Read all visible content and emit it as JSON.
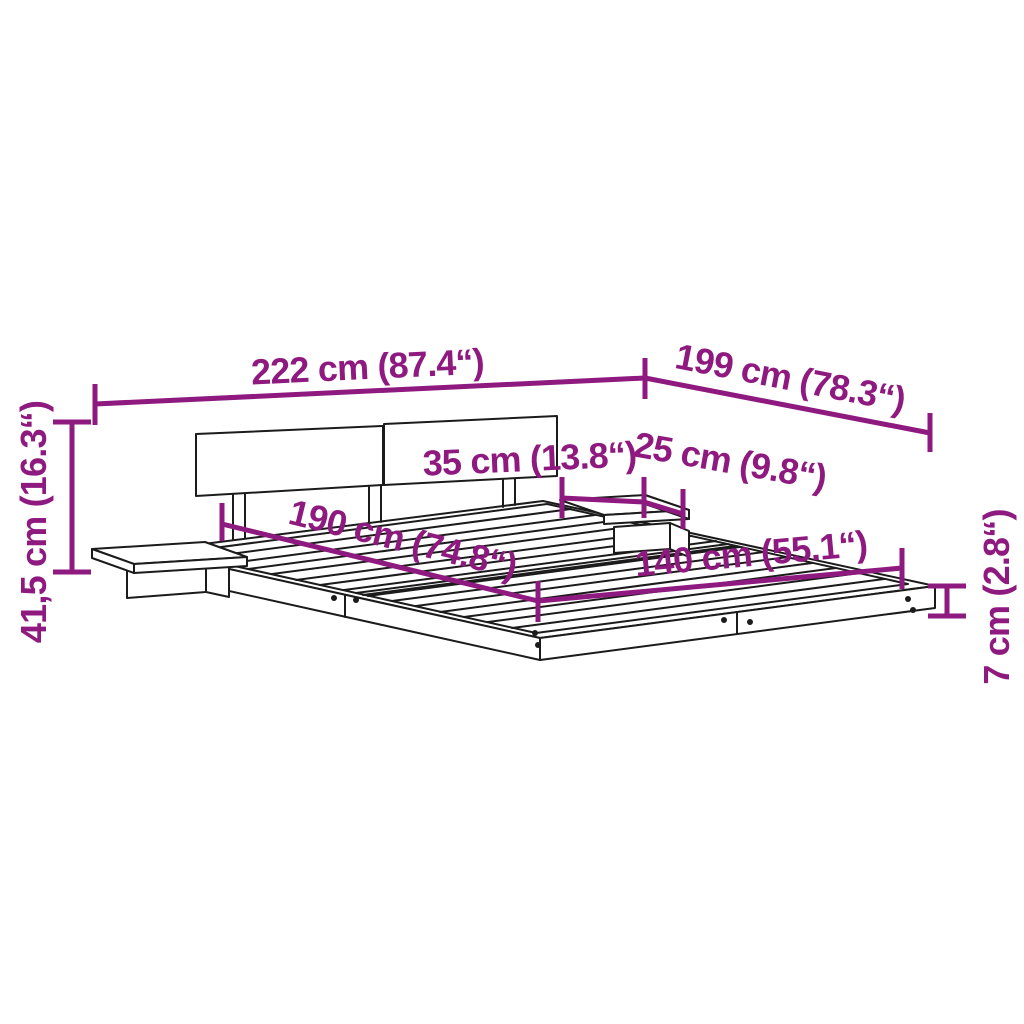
{
  "diagram": {
    "name": "bed-frame-dimension-diagram",
    "background": "#ffffff",
    "accent_color": "#8E1A80",
    "line_color": "#1b1b1b",
    "dimensions": [
      {
        "id": "total-width",
        "label": "222 cm (87.4“)",
        "value_cm": "222 cm",
        "value_inch": "87.4“"
      },
      {
        "id": "total-depth",
        "label": "199 cm (78.3“)",
        "value_cm": "199 cm",
        "value_inch": "78.3“"
      },
      {
        "id": "total-height",
        "label": "41,5 cm (16.3“)",
        "value_cm": "41,5 cm",
        "value_inch": "16.3“"
      },
      {
        "id": "shelf-depth",
        "label": "35 cm (13.8“)",
        "value_cm": "35 cm",
        "value_inch": "13.8“"
      },
      {
        "id": "shelf-width",
        "label": "25 cm (9.8“)",
        "value_cm": "25 cm",
        "value_inch": "9.8“"
      },
      {
        "id": "sleeping-length",
        "label": "190 cm (74.8“)",
        "value_cm": "190 cm",
        "value_inch": "74.8“"
      },
      {
        "id": "sleeping-width",
        "label": "140 cm (55.1“)",
        "value_cm": "140 cm",
        "value_inch": "55.1“"
      },
      {
        "id": "platform-height",
        "label": "7 cm (2.8“)",
        "value_cm": "7 cm",
        "value_inch": "2.8“"
      }
    ]
  }
}
